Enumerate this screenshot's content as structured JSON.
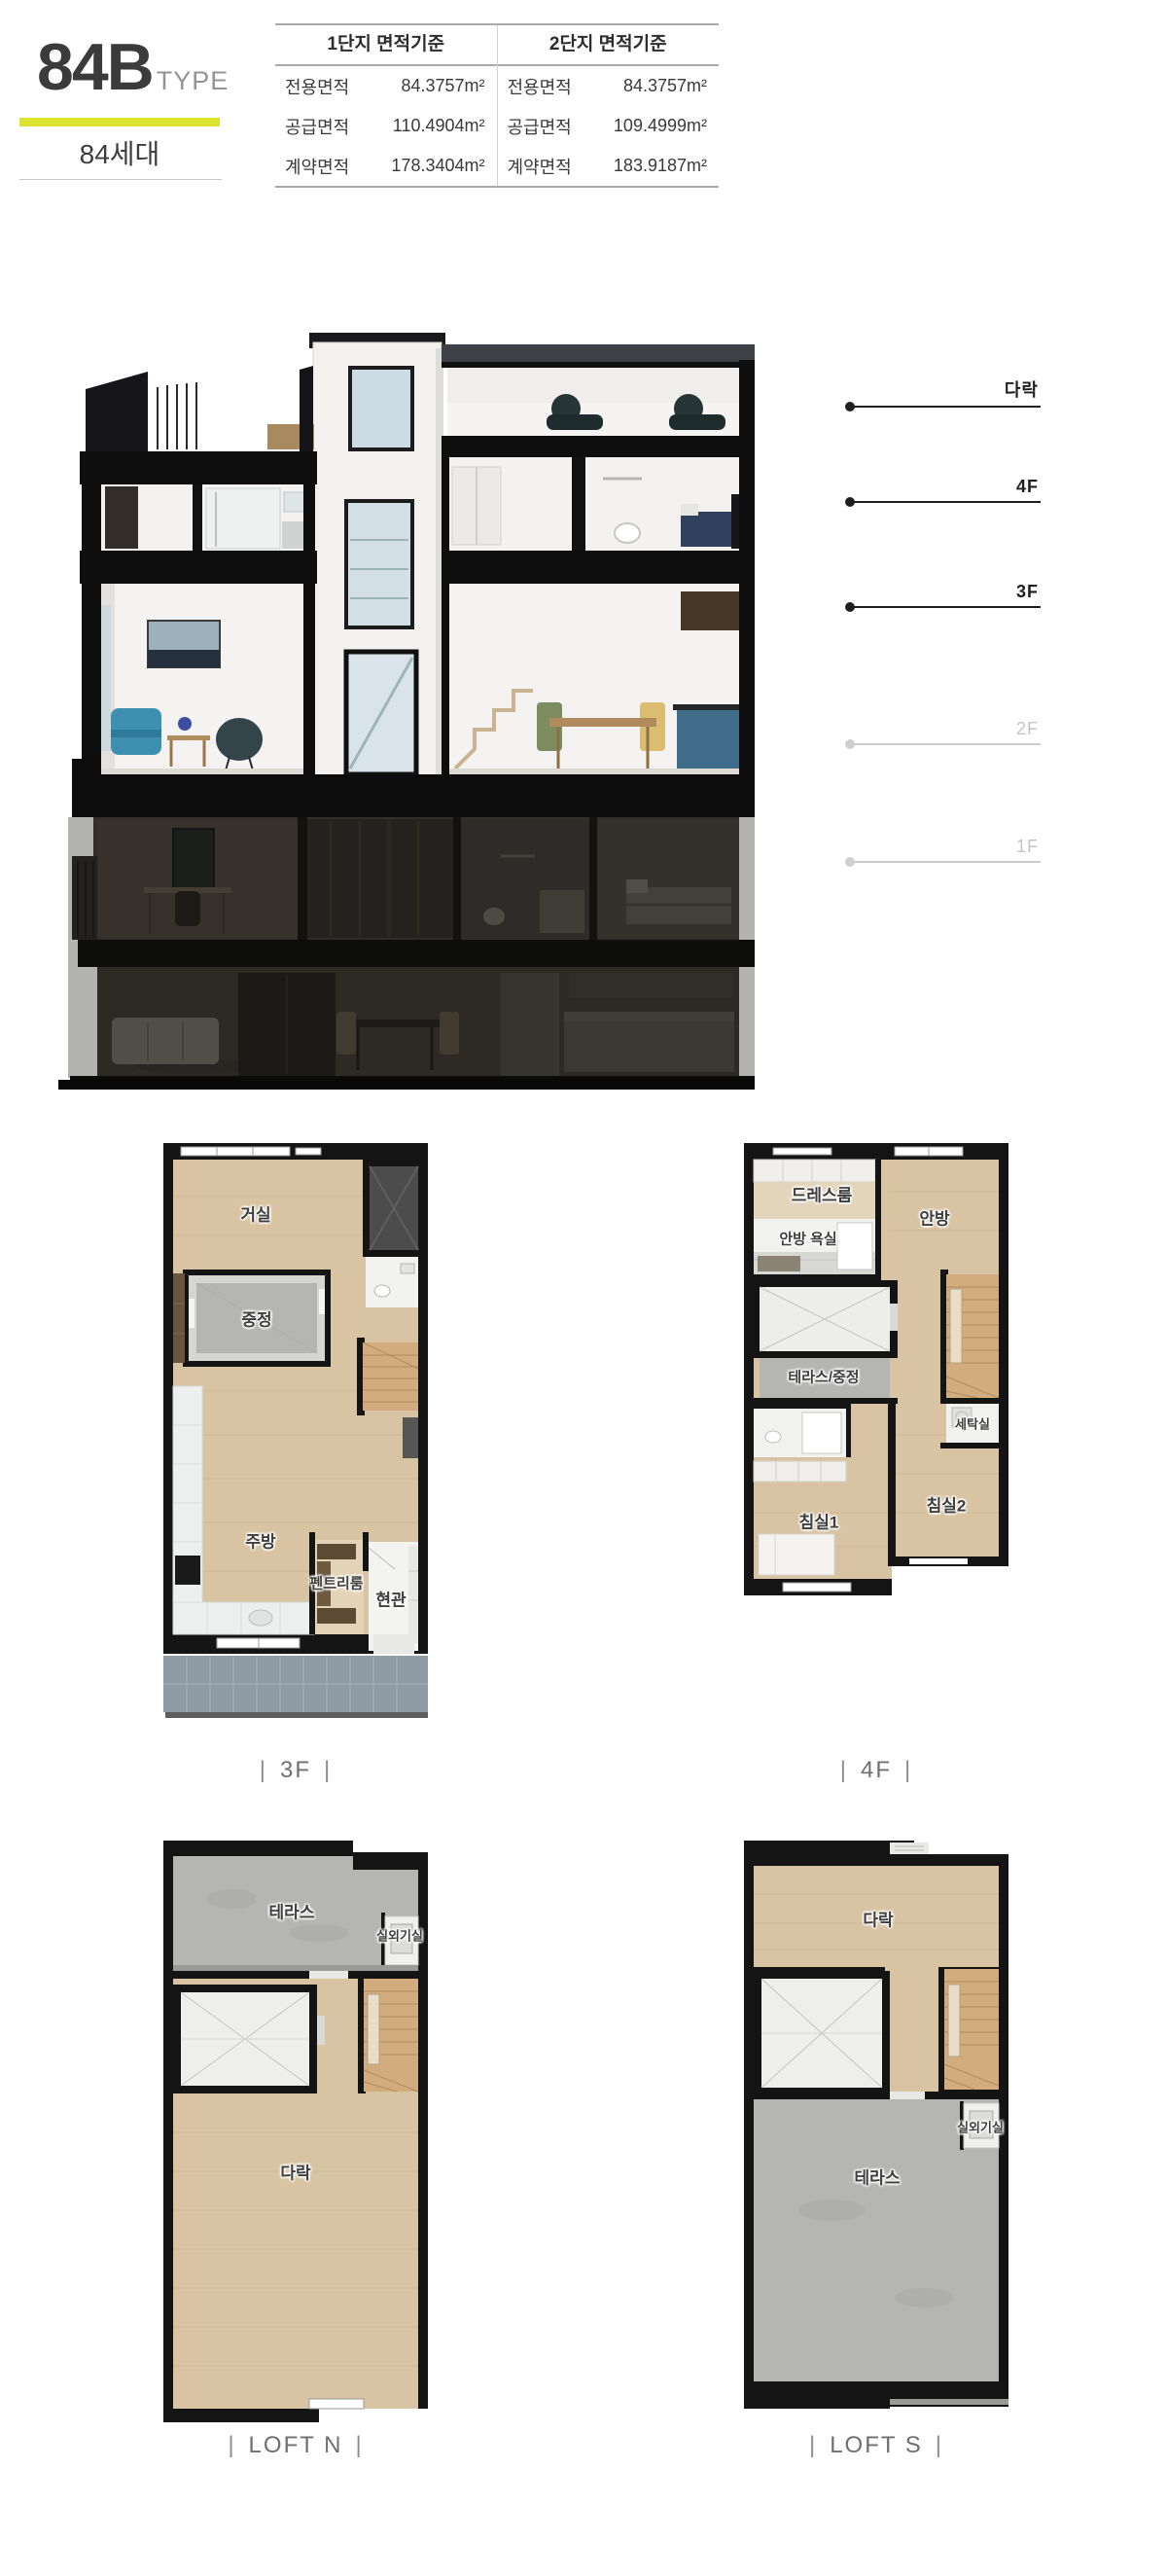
{
  "header": {
    "type_code": "84B",
    "type_suffix": "TYPE",
    "units": "84세대"
  },
  "area_table": {
    "columns": [
      {
        "title": "1단지 면적기준",
        "rows": [
          {
            "label": "전용면적",
            "value": "84.3757m²"
          },
          {
            "label": "공급면적",
            "value": "110.4904m²"
          },
          {
            "label": "계약면적",
            "value": "178.3404m²"
          }
        ]
      },
      {
        "title": "2단지 면적기준",
        "rows": [
          {
            "label": "전용면적",
            "value": "84.3757m²"
          },
          {
            "label": "공급면적",
            "value": "109.4999m²"
          },
          {
            "label": "계약면적",
            "value": "183.9187m²"
          }
        ]
      }
    ]
  },
  "section_view": {
    "floor_labels": [
      {
        "label": "다락",
        "active": true
      },
      {
        "label": "4F",
        "active": true
      },
      {
        "label": "3F",
        "active": true
      },
      {
        "label": "2F",
        "active": false
      },
      {
        "label": "1F",
        "active": false
      }
    ]
  },
  "floor_plans": {
    "f3": {
      "caption": "3F",
      "rooms": {
        "living": "거실",
        "courtyard": "중정",
        "kitchen": "주방",
        "pantry": "펜트리룸",
        "entrance": "현관"
      }
    },
    "f4": {
      "caption": "4F",
      "rooms": {
        "dress": "드레스룸",
        "master": "안방",
        "master_bath": "안방 욕실",
        "terrace_court": "테라스/중정",
        "laundry": "세탁실",
        "bed1": "침실1",
        "bed2": "침실2"
      }
    },
    "loft_n": {
      "caption": "LOFT N",
      "rooms": {
        "terrace": "테라스",
        "ac": "실외기실",
        "loft": "다락"
      }
    },
    "loft_s": {
      "caption": "LOFT S",
      "rooms": {
        "loft": "다락",
        "ac": "실외기실",
        "terrace": "테라스"
      }
    }
  },
  "ui": {
    "caption_bar": "|",
    "colors": {
      "accent": "#dce32e",
      "wall": "#141414",
      "wood_floor": "#d8c3a2",
      "concrete": "#b5b5b3",
      "tile": "#8f9ca6",
      "label_active": "#1f1f1f",
      "label_inactive": "#c3c3c3"
    }
  }
}
